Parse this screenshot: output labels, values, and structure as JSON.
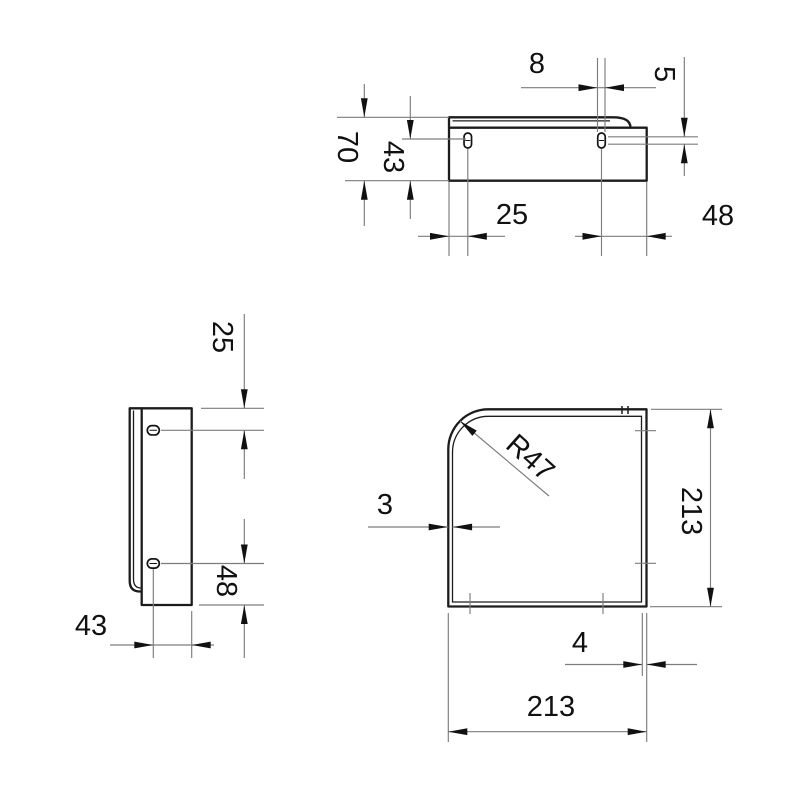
{
  "drawing": {
    "type": "technical-orthographic-drawing",
    "background_color": "#ffffff",
    "outline_color": "#1c1c1c",
    "dimension_line_color": "#7d7d7d",
    "text_color": "#111111",
    "views": {
      "front_view": {
        "description": "bracket seen from front, top right of sheet",
        "dims": {
          "overall_height": "70",
          "slot_center_to_bottom": "43",
          "slot_width": "8",
          "slot_straight_length": "5",
          "left_edge_to_slot": "25",
          "slot_to_right_edge": "48"
        }
      },
      "side_view": {
        "description": "bracket seen from side, middle left of sheet",
        "dims": {
          "top_edge_to_slot": "25",
          "slot_to_bottom_edge": "48",
          "slot_center_to_front_face": "43"
        }
      },
      "plan_view": {
        "description": "shelf plate seen from above, bottom right of sheet",
        "dims": {
          "corner_radius": "R47",
          "material_thickness": "3",
          "side_depth": "213",
          "side_width": "213",
          "edge_gap": "4"
        }
      }
    }
  }
}
